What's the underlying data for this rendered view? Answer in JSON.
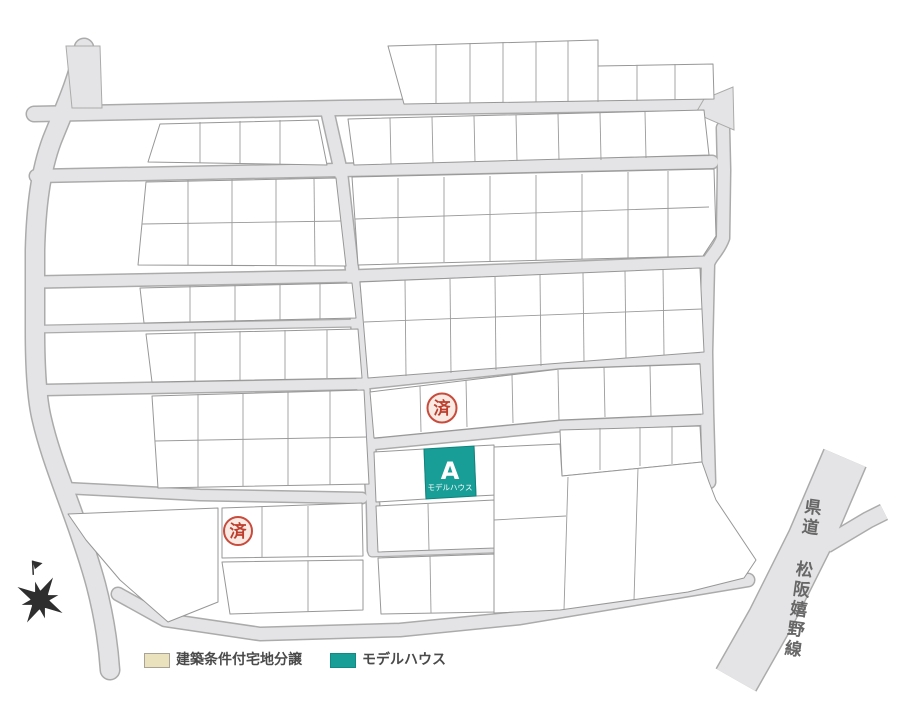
{
  "map": {
    "model_house_lot": {
      "label": "A",
      "sublabel": "モデルハウス",
      "color": "#189e97"
    },
    "sold_stamp": {
      "text": "済",
      "color": "#c84b3c"
    },
    "prefectural_road_label": "県道 松阪嬉野線",
    "road_color": "#e4e4e6",
    "compass_icon": "compass-rose"
  },
  "legend": {
    "items": [
      {
        "label": "建築条件付宅地分譲",
        "swatch_color": "#eae1bd"
      },
      {
        "label": "モデルハウス",
        "swatch_color": "#189e97"
      }
    ]
  }
}
